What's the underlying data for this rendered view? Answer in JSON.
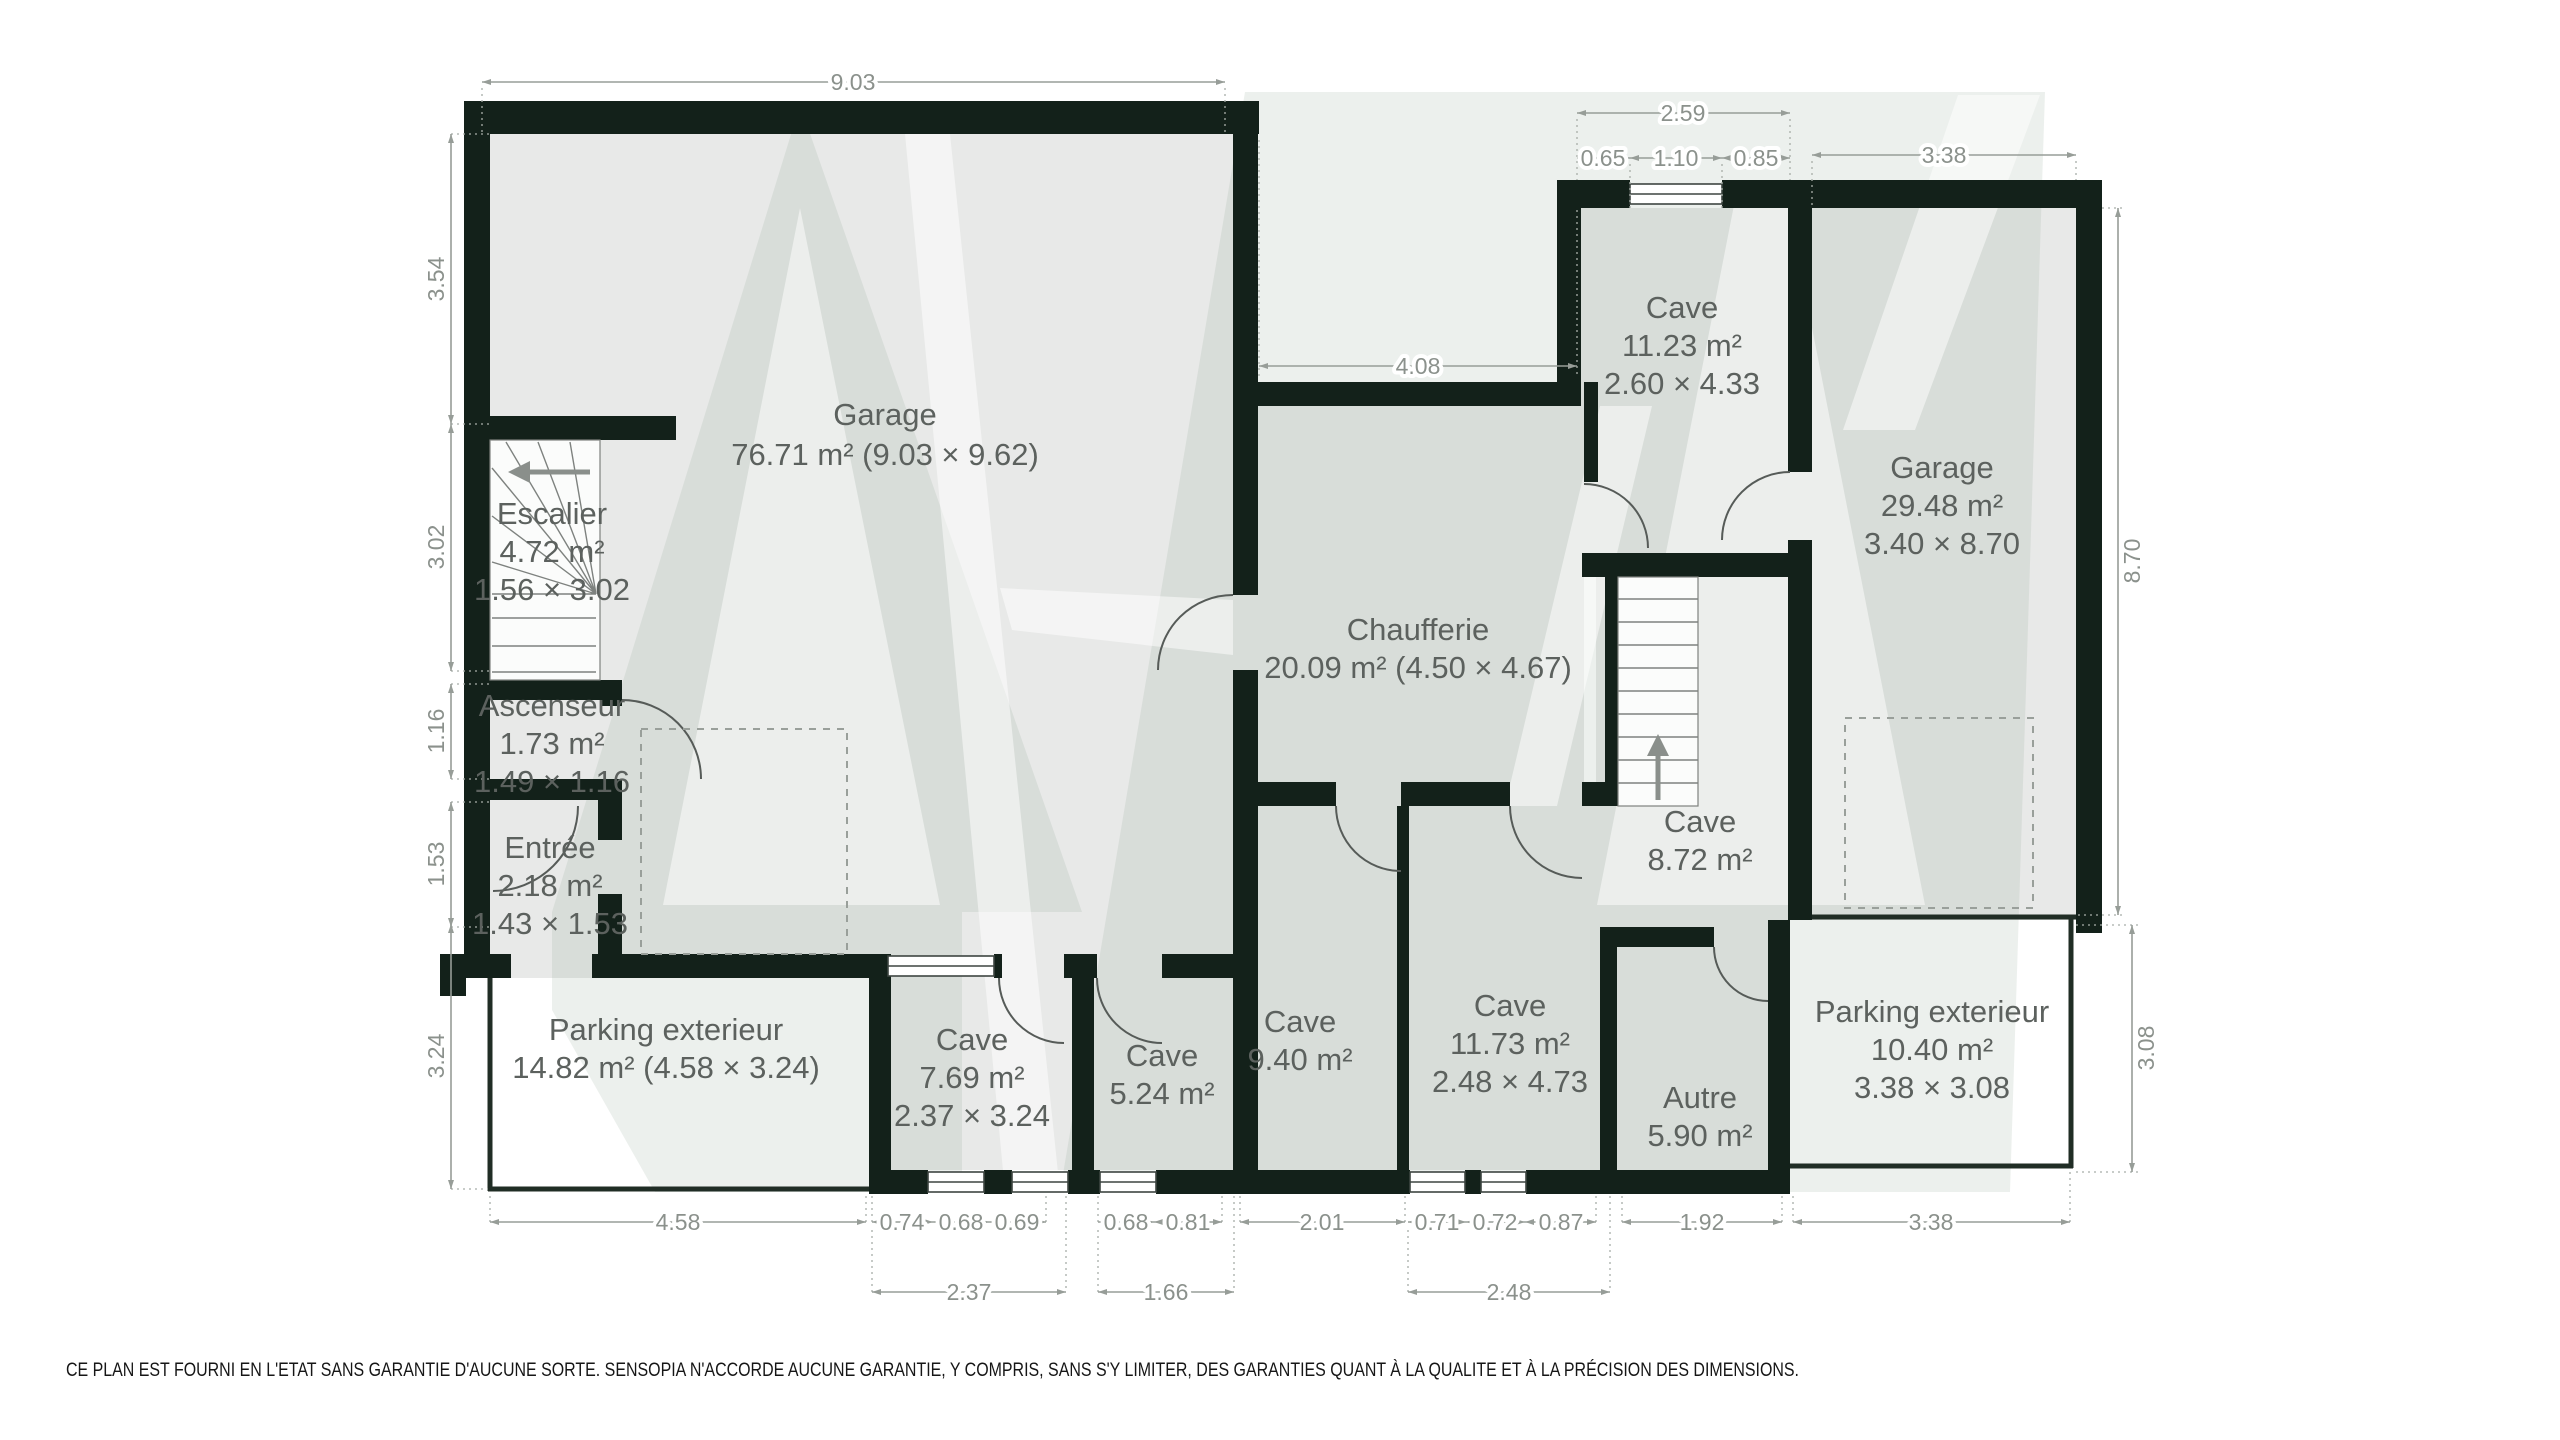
{
  "plan": {
    "rooms": {
      "garage_left": {
        "name": "Garage",
        "details": "76.71 m² (9.03 × 9.62)"
      },
      "escalier": {
        "name": "Escalier",
        "area": "4.72 m²",
        "size": "1.56 × 3.02"
      },
      "ascenseur": {
        "name": "Ascenseur",
        "area": "1.73 m²",
        "size": "1.49 × 1.16"
      },
      "entree": {
        "name": "Entrée",
        "area": "2.18 m²",
        "size": "1.43 × 1.53"
      },
      "chaufferie": {
        "name": "Chaufferie",
        "details": "20.09 m² (4.50 × 4.67)"
      },
      "cave_nord": {
        "name": "Cave",
        "area": "11.23 m²",
        "size": "2.60 × 4.33"
      },
      "garage_right": {
        "name": "Garage",
        "area": "29.48 m²",
        "size": "3.40 × 8.70"
      },
      "cave_centre": {
        "name": "Cave",
        "area": "8.72 m²"
      },
      "parking_left": {
        "name": "Parking exterieur",
        "details": "14.82 m² (4.58 × 3.24)"
      },
      "cave_769": {
        "name": "Cave",
        "area": "7.69 m²",
        "size": "2.37 × 3.24"
      },
      "cave_524": {
        "name": "Cave",
        "area": "5.24 m²"
      },
      "cave_940": {
        "name": "Cave",
        "area": "9.40 m²"
      },
      "cave_1173": {
        "name": "Cave",
        "area": "11.73 m²",
        "size": "2.48 × 4.73"
      },
      "autre": {
        "name": "Autre",
        "area": "5.90 m²"
      },
      "parking_right": {
        "name": "Parking exterieur",
        "area": "10.40 m²",
        "size": "3.38 × 3.08"
      }
    },
    "dimensions": {
      "top_garage": "9.03",
      "top_cave": "2.59",
      "top_cave_a": "0.65",
      "top_cave_b": "1.10",
      "top_cave_c": "0.85",
      "top_garage_r": "3.38",
      "chaufferie_top": "4.08",
      "left_a": "3.54",
      "left_b": "3.02",
      "left_c": "1.16",
      "left_d": "1.53",
      "left_e": "3.24",
      "right_a": "8.70",
      "right_b": "3.08",
      "bottom_parking_l": "4.58",
      "bottom_a": "0.74",
      "bottom_b": "0.68",
      "bottom_c": "0.69",
      "bottom_d": "0.68",
      "bottom_e": "0.81",
      "bottom_corridor": "2.01",
      "bottom_f": "0.71",
      "bottom_g": "0.72",
      "bottom_h": "0.87",
      "bottom_autre": "1.92",
      "bottom_parking_r": "3.38",
      "bottom2_cave769": "2.37",
      "bottom2_cave524": "1.66",
      "bottom2_cave1173": "2.48"
    },
    "disclaimer": "CE PLAN EST FOURNI EN L'ETAT SANS GARANTIE D'AUCUNE SORTE. SENSOPIA N'ACCORDE AUCUNE GARANTIE, Y COMPRIS, SANS S'Y LIMITER, DES GARANTIES QUANT À LA QUALITE ET À LA PRÉCISION DES DIMENSIONS.",
    "colors": {
      "wall": "#13211a",
      "floor": "#e8e9e8",
      "dimension_text": "#8b918c",
      "room_text": "#5c615e",
      "watermark_tint": "#8ba092",
      "exterior_line": "#202d25"
    }
  }
}
